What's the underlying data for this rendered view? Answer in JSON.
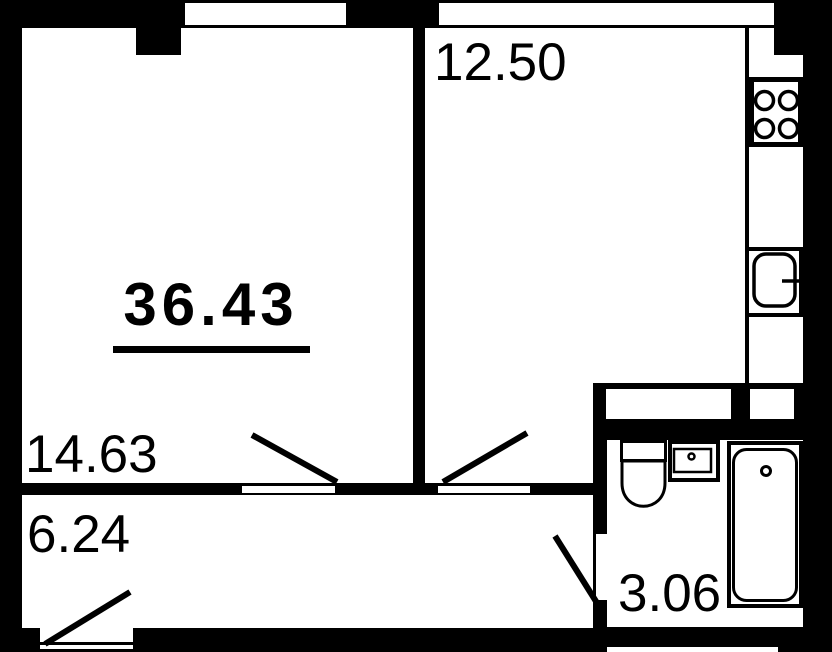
{
  "floor_plan": {
    "total_area": "36.43",
    "rooms": [
      {
        "name": "living-room",
        "area": "14.63"
      },
      {
        "name": "kitchen",
        "area": "12.50"
      },
      {
        "name": "hallway",
        "area": "6.24"
      },
      {
        "name": "bathroom",
        "area": "3.06"
      }
    ],
    "colors": {
      "wall": "#000000",
      "floor": "#ffffff"
    }
  }
}
